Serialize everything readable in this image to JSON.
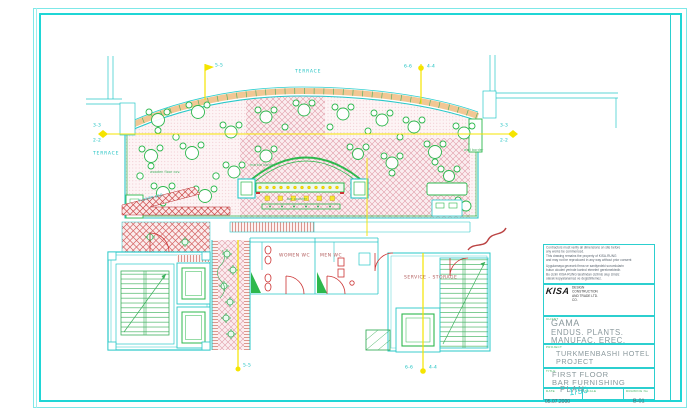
{
  "plan": {
    "terrace_top": "TERRACE",
    "terrace_left": "TERRACE",
    "marker_55": "5-5",
    "marker_66": "6-6",
    "marker_44": "4-4",
    "marker_33": "3-3",
    "marker_22": "2-2",
    "women_wc": "WOMEN WC",
    "men_wc": "MEN WC",
    "service_storage": "SERVICE - STORAGE",
    "flower_bed": "FLOWER BED",
    "annotations": [
      {
        "text": "wooden floor cov."
      },
      {
        "text": "marble border"
      },
      {
        "text": "bar counter"
      },
      {
        "text": "wall border"
      }
    ]
  },
  "title_block": {
    "notes_en": [
      "Contractors must verify all dimensions on site before",
      "any works be commenced.",
      "This drawing remains the property of  KISA-RUNG",
      "and may not be reproduced in any way without prior consent"
    ],
    "notes_tr": [
      "Uygulamaya gececek firma ve santiyedeki sorumlularin",
      "butun olculeri yerinde kontrol etmeleri gerekmektedir.",
      "Bu cizim KISA-RUNG tarafindan cizilmis olup izinsiz",
      "olarak kopyalanamaz ve degistirilemez."
    ],
    "company": {
      "logo": "KISA",
      "logo_line1": "DESIGN CONSTRUCTION",
      "logo_line2": "AND TRADE LTD. CO.",
      "partner_line1": "RUNG ARCHITECTURAL - INTERIOR DESIGN",
      "partner_line2": "& CONSTRUCTION CO.",
      "tel": "TEL:(0312) 446 75 24",
      "fax": "FAX:(0312) 446 24 42",
      "mob": "MOB:(0532) 243 65 48",
      "address": "Cevizlidere cad. Ayten sok. No:4 / 7-14  Ankara / TURKEY"
    },
    "client": {
      "label": "CLIENT",
      "line1": "GAMA",
      "line2": "ENDUS. PLANTS.",
      "line3": "MANUFAC. EREC. CORP."
    },
    "project": {
      "label": "PROJECT",
      "line1": "TURKMENBASHI HOTEL",
      "line2": "PROJECT"
    },
    "title": {
      "label": "TITLE",
      "line1": "FIRST FLOOR",
      "line2": "BAR FURNISHING",
      "line3": "PLAN"
    },
    "date": {
      "label": "DATE",
      "value": "05.07.2000"
    },
    "scale": {
      "label": "SCALE",
      "value": "1/50"
    },
    "drawing_no": {
      "label": "DRAWING No",
      "value": "B-01"
    }
  },
  "colors": {
    "frame": "#1fd6d6",
    "wall": "#28c8c8",
    "green": "#2db84d",
    "yellow": "#f5e400",
    "red": "#cc3333",
    "hatch_pink": "#e09aa6",
    "text_gray": "#8a989c",
    "label_green": "#3cb05c",
    "label_cyan": "#18c0c0"
  }
}
